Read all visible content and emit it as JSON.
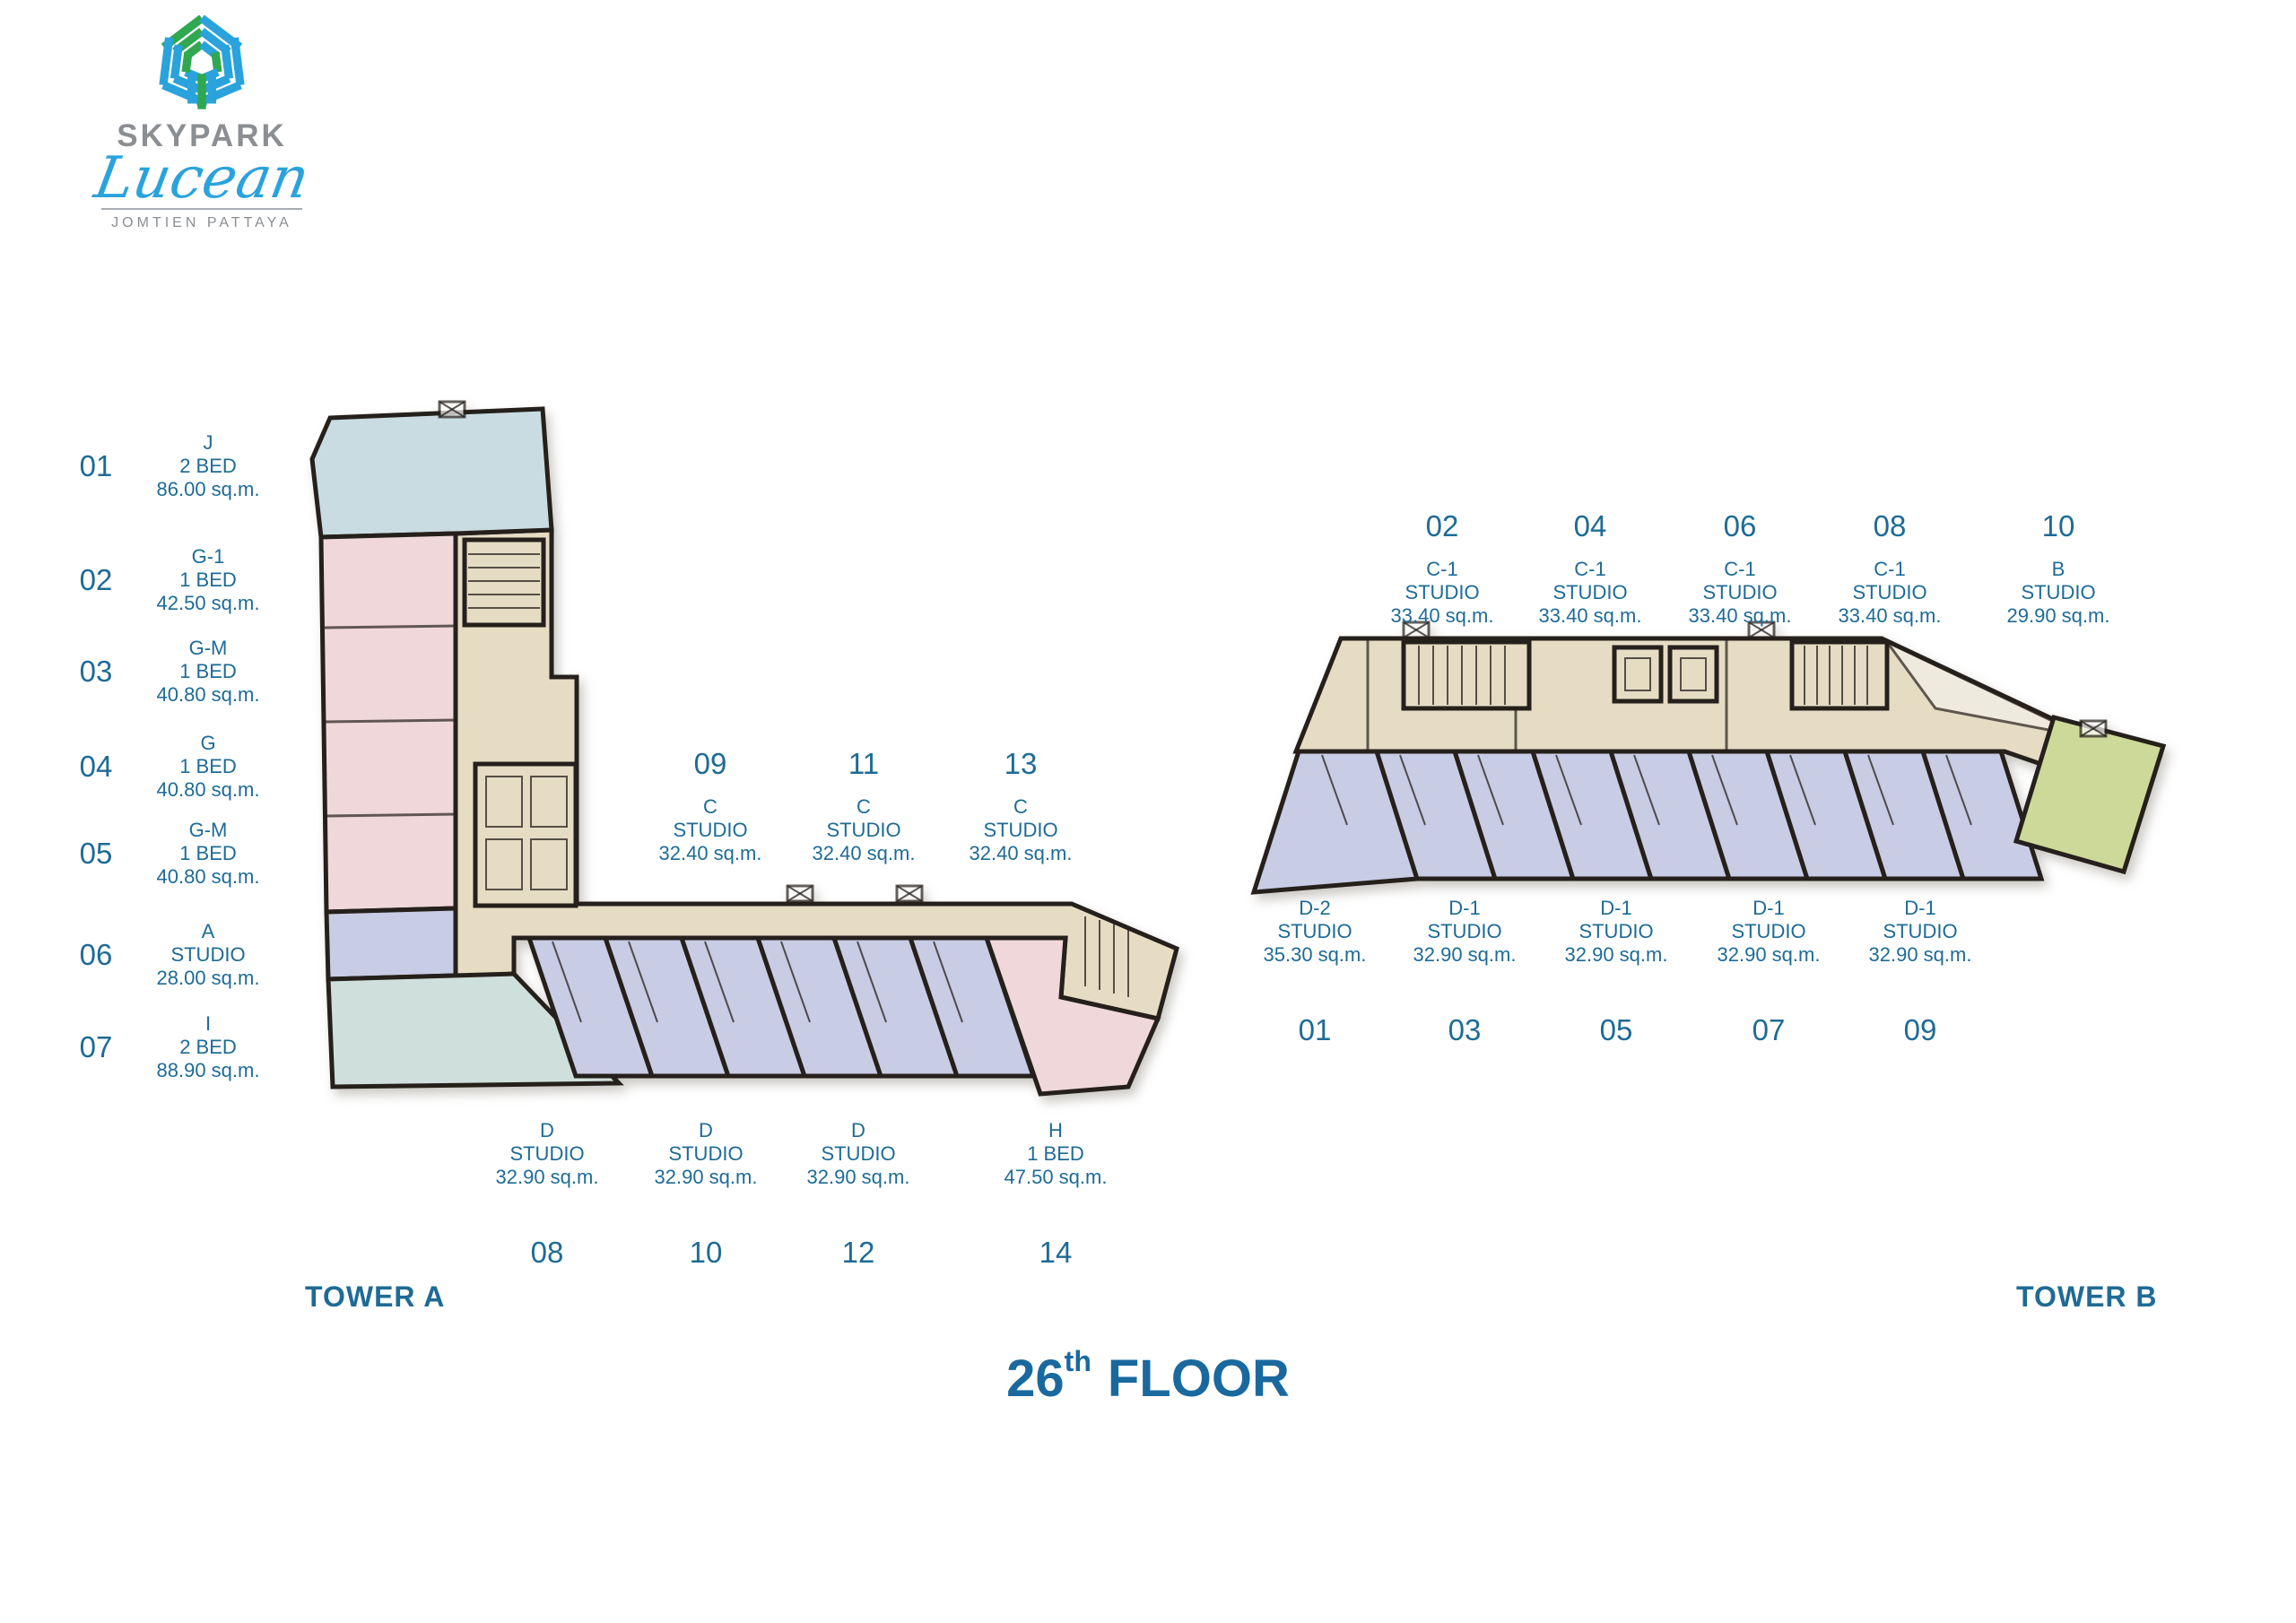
{
  "logo": {
    "name": "SKYPARK",
    "script": "Lucean",
    "subtitle": "JOMTIEN PATTAYA"
  },
  "floor_title": {
    "number": "26",
    "ordinal": "th",
    "word": "FLOOR"
  },
  "tower_a": {
    "label": "TOWER A",
    "left_units": [
      {
        "no": "01",
        "type": "J",
        "layout": "2 BED",
        "area": "86.00 sq.m."
      },
      {
        "no": "02",
        "type": "G-1",
        "layout": "1 BED",
        "area": "42.50 sq.m."
      },
      {
        "no": "03",
        "type": "G-M",
        "layout": "1 BED",
        "area": "40.80 sq.m."
      },
      {
        "no": "04",
        "type": "G",
        "layout": "1 BED",
        "area": "40.80 sq.m."
      },
      {
        "no": "05",
        "type": "G-M",
        "layout": "1 BED",
        "area": "40.80 sq.m."
      },
      {
        "no": "06",
        "type": "A",
        "layout": "STUDIO",
        "area": "28.00 sq.m."
      },
      {
        "no": "07",
        "type": "I",
        "layout": "2 BED",
        "area": "88.90 sq.m."
      }
    ],
    "corridor_units": [
      {
        "no": "09",
        "type": "C",
        "layout": "STUDIO",
        "area": "32.40 sq.m."
      },
      {
        "no": "11",
        "type": "C",
        "layout": "STUDIO",
        "area": "32.40 sq.m."
      },
      {
        "no": "13",
        "type": "C",
        "layout": "STUDIO",
        "area": "32.40 sq.m."
      }
    ],
    "lower_units": [
      {
        "no": "08",
        "type": "D",
        "layout": "STUDIO",
        "area": "32.90 sq.m."
      },
      {
        "no": "10",
        "type": "D",
        "layout": "STUDIO",
        "area": "32.90 sq.m."
      },
      {
        "no": "12",
        "type": "D",
        "layout": "STUDIO",
        "area": "32.90 sq.m."
      },
      {
        "no": "14",
        "type": "H",
        "layout": "1 BED",
        "area": "47.50 sq.m."
      }
    ]
  },
  "tower_b": {
    "label": "TOWER B",
    "upper_units": [
      {
        "no": "02",
        "type": "C-1",
        "layout": "STUDIO",
        "area": "33.40 sq.m."
      },
      {
        "no": "04",
        "type": "C-1",
        "layout": "STUDIO",
        "area": "33.40 sq.m."
      },
      {
        "no": "06",
        "type": "C-1",
        "layout": "STUDIO",
        "area": "33.40 sq.m."
      },
      {
        "no": "08",
        "type": "C-1",
        "layout": "STUDIO",
        "area": "33.40 sq.m."
      },
      {
        "no": "10",
        "type": "B",
        "layout": "STUDIO",
        "area": "29.90 sq.m."
      }
    ],
    "lower_units": [
      {
        "no": "01",
        "type": "D-2",
        "layout": "STUDIO",
        "area": "35.30 sq.m."
      },
      {
        "no": "03",
        "type": "D-1",
        "layout": "STUDIO",
        "area": "32.90 sq.m."
      },
      {
        "no": "05",
        "type": "D-1",
        "layout": "STUDIO",
        "area": "32.90 sq.m."
      },
      {
        "no": "07",
        "type": "D-1",
        "layout": "STUDIO",
        "area": "32.90 sq.m."
      },
      {
        "no": "09",
        "type": "D-1",
        "layout": "STUDIO",
        "area": "32.90 sq.m."
      }
    ]
  },
  "colors": {
    "teal": "#1e6b96",
    "heading": "#1a699e",
    "logo_gray": "#8b8e92",
    "logo_blue": "#2aa3dc",
    "logo_green": "#2fa84f",
    "wall": "#26201c",
    "u_blue": "#c9dce2",
    "u_pink": "#f0d8da",
    "u_lav": "#c8cce4",
    "u_beige": "#e6dcc4",
    "u_teal": "#cfdfdc",
    "u_green": "#ccd998",
    "wedge": "#f4f1ea"
  }
}
